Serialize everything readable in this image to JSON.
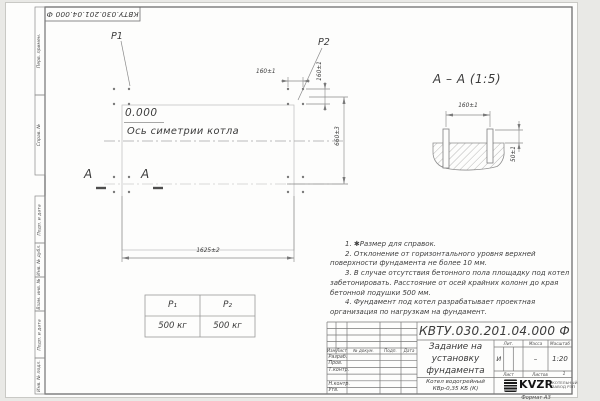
{
  "sheet": {
    "top_designation": "КВТУ.030.201.04.000 Ф",
    "format_label": "Формат А3",
    "margin_fields": {
      "perv": "Перв. примен.",
      "sprav": "Справ. №",
      "podp1": "Подп. и дата",
      "inv_dubl": "Инв. № дубл.",
      "vzam": "Взам. инв. №",
      "podp2": "Подп. и дата",
      "inv_podl": "Инв. № подл."
    }
  },
  "plan": {
    "p1": "Р1",
    "p2": "Р2",
    "elevation": "0.000",
    "axis_label": "Ось симетрии котла",
    "dim_length": "1625±2",
    "dim_depth": "660±3",
    "dim_bolt_h": "160±1",
    "dim_bolt_v": "160±1",
    "section_letter": "А"
  },
  "section": {
    "title": "А – А (1:5)",
    "dim_spacing": "160±1",
    "dim_protrusion": "50±1"
  },
  "loads": {
    "col1": "Р₁",
    "col2": "Р₂",
    "val1": "500 кг",
    "val2": "500 кг"
  },
  "notes": {
    "n1": "1. ✱Размер для справок.",
    "n2": "2. Отклонение от горизонтального уровня верхней поверхности фундамента не более 10 мм.",
    "n3": "3. В случае отсутствия бетонного пола площадку под котел забетонировать. Расстояние от осей крайних колонн до края бетонной подушки 500 мм.",
    "n4": "4. Фундамент под котел разрабатывает проектная организация по нагрузкам на фундамент."
  },
  "title_block": {
    "designation": "КВТУ.030.201.04.000 Ф",
    "title_l1": "Задание на",
    "title_l2": "установку",
    "title_l3": "фундамента",
    "product_l1": "Котел водогрейный",
    "product_l2": "КВр-0,35 КБ (К)",
    "col_izm": "Изм.",
    "col_list": "Лист",
    "col_doc": "№ докум.",
    "col_podp": "Подп.",
    "col_data": "Дата",
    "row_razrab": "Разраб.",
    "row_prov": "Пров.",
    "row_tkontr": "Т.контр.",
    "row_nkontr": "Н.контр.",
    "row_utv": "Утв.",
    "lit_label": "Лит.",
    "lit_value": "И",
    "mass_label": "Масса",
    "mass_value": "–",
    "scale_label": "Масштаб",
    "scale_value": "1:20",
    "list_label": "Лист",
    "listov_label": "Листов",
    "listov_value": "1",
    "logo_text": "KVZR",
    "logo_cap_l1": "КОТЕЛЬНЫЙ",
    "logo_cap_l2": "ЗАВОД РЭП"
  },
  "colors": {
    "line": "#8a8a8a",
    "text": "#3b3b3b"
  }
}
